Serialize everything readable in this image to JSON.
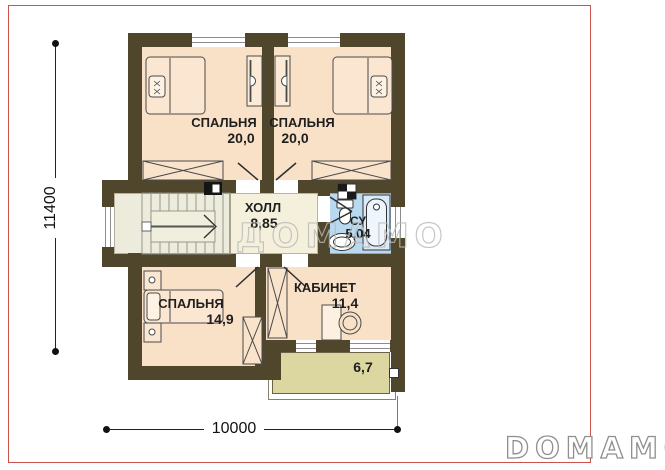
{
  "watermark": {
    "center_text": "ДОМАМО",
    "logo_text": "DOMAMO"
  },
  "dimensions": {
    "height_label": "11400",
    "width_label": "10000"
  },
  "rooms": {
    "bedroom1": {
      "name": "СПАЛЬНЯ",
      "area": "20,0"
    },
    "bedroom2": {
      "name": "СПАЛЬНЯ",
      "area": "20,0"
    },
    "hall": {
      "name": "ХОЛЛ",
      "area": "8,85"
    },
    "bathroom": {
      "name": "СУ",
      "area": "5,04"
    },
    "bedroom3": {
      "name": "СПАЛЬНЯ",
      "area": "14,9"
    },
    "office": {
      "name": "КАБИНЕТ",
      "area": "11,4"
    },
    "balcony": {
      "area": "6,7"
    }
  },
  "colors": {
    "wall": "#4f462c",
    "room_fill": "#f8e1c7",
    "hall_fill": "#f4f0dc",
    "stair_fill": "#ecebdc",
    "bathroom_fill": "#b9d9f1",
    "balcony_fill": "#dcd7a0",
    "frame": "#cb5349",
    "watermark_gray": "#b9b9b9"
  }
}
